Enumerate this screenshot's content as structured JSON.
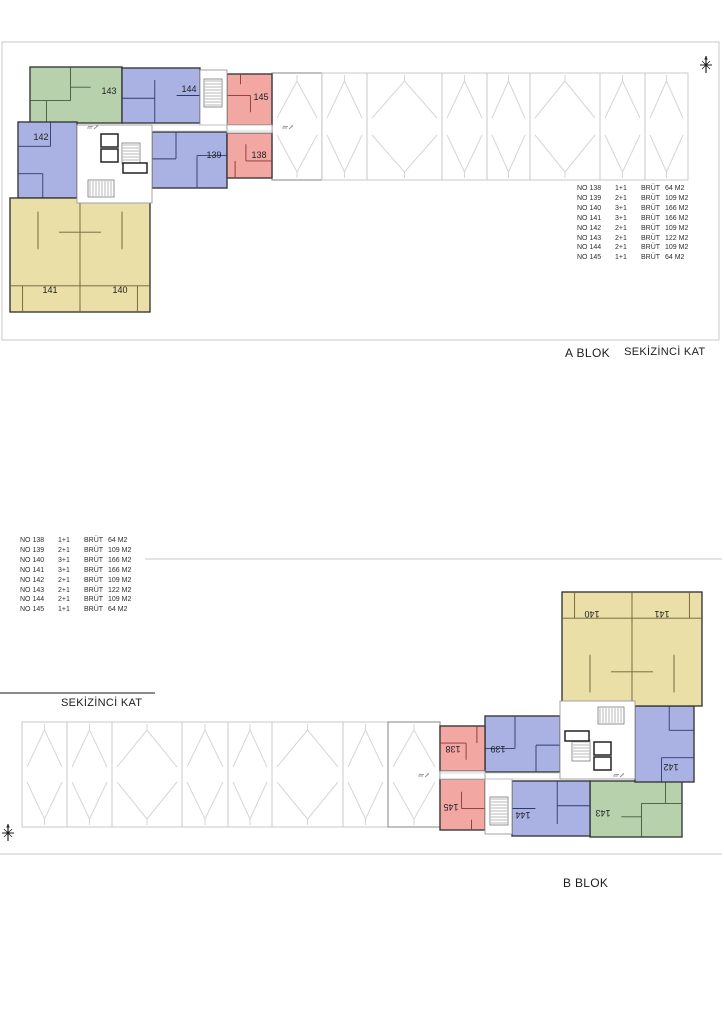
{
  "titles": {
    "a_block": "A BLOK",
    "a_floor": "SEKİZİNCİ KAT",
    "b_block": "B BLOK",
    "b_floor": "SEKİZİNCİ KAT"
  },
  "legend": {
    "rows": [
      {
        "no": "NO 138",
        "tip": "1+1",
        "brut": "BRÜT",
        "m2": "64 M2"
      },
      {
        "no": "NO 139",
        "tip": "2+1",
        "brut": "BRÜT",
        "m2": "109 M2"
      },
      {
        "no": "NO 140",
        "tip": "3+1",
        "brut": "BRÜT",
        "m2": "166 M2"
      },
      {
        "no": "NO 141",
        "tip": "3+1",
        "brut": "BRÜT",
        "m2": "166 M2"
      },
      {
        "no": "NO 142",
        "tip": "2+1",
        "brut": "BRÜT",
        "m2": "109 M2"
      },
      {
        "no": "NO 143",
        "tip": "2+1",
        "brut": "BRÜT",
        "m2": "122 M2"
      },
      {
        "no": "NO 144",
        "tip": "2+1",
        "brut": "BRÜT",
        "m2": "109 M2"
      },
      {
        "no": "NO 145",
        "tip": "1+1",
        "brut": "BRÜT",
        "m2": "64 M2"
      }
    ]
  },
  "colors": {
    "green": "#b7d1ad",
    "blue": "#a9b2e2",
    "red": "#f2a7a3",
    "yellow": "#eadfa6",
    "green_dark": "#3c5a3c",
    "blue_dark": "#2c3a72",
    "red_dark": "#8a3535",
    "yellow_dark": "#6b6138",
    "outline": "#3a3a3a",
    "frame": "#c9c9c9",
    "roof": "#d6d6d6",
    "midgray": "#9a9a9a",
    "core": "#9a9a9a",
    "label": "#222222",
    "note": "#8a8a8a"
  },
  "plan": {
    "a_origin": {
      "x": 10,
      "y": 67,
      "w": 262,
      "h": 245
    },
    "b_origin": {
      "x": 442,
      "y": 592,
      "w": 260,
      "h": 245
    },
    "units": [
      {
        "id": "143",
        "color": "green",
        "x": 30,
        "y": 67,
        "w": 92,
        "h": 56,
        "labels": [
          {
            "text": "143",
            "x": 109,
            "y": 91
          }
        ],
        "walls": [
          [
            0.44,
            0,
            0.44,
            0.6
          ],
          [
            0,
            0.6,
            0.44,
            0.6
          ],
          [
            0.44,
            0.36,
            0.66,
            0.36
          ],
          [
            0.18,
            0.6,
            0.18,
            1
          ]
        ]
      },
      {
        "id": "144",
        "color": "blue",
        "x": 122,
        "y": 68,
        "w": 78,
        "h": 55,
        "labels": [
          {
            "text": "144",
            "x": 189,
            "y": 89
          }
        ],
        "walls": [
          [
            0.42,
            0.22,
            0.42,
            1
          ],
          [
            0,
            0.55,
            0.42,
            0.55
          ],
          [
            0.7,
            0.5,
            1,
            0.5
          ]
        ]
      },
      {
        "id": "145",
        "color": "red",
        "x": 227,
        "y": 74,
        "w": 45,
        "h": 51,
        "labels": [
          {
            "text": "145",
            "x": 261,
            "y": 97
          }
        ],
        "walls": [
          [
            0,
            0.42,
            0.52,
            0.42
          ],
          [
            0.52,
            0.42,
            0.52,
            0.75
          ],
          [
            0.3,
            0,
            0.3,
            0.2
          ]
        ]
      },
      {
        "id": "142",
        "color": "blue",
        "x": 18,
        "y": 122,
        "w": 59,
        "h": 76,
        "labels": [
          {
            "text": "142",
            "x": 41,
            "y": 137
          }
        ],
        "walls": [
          [
            0,
            0.32,
            0.55,
            0.32
          ],
          [
            0.55,
            0,
            0.55,
            0.32
          ],
          [
            0,
            0.68,
            0.42,
            0.68
          ],
          [
            0.42,
            0.68,
            0.42,
            1
          ]
        ]
      },
      {
        "id": "139",
        "color": "blue",
        "x": 152,
        "y": 132,
        "w": 75,
        "h": 56,
        "labels": [
          {
            "text": "139",
            "x": 214,
            "y": 155
          }
        ],
        "walls": [
          [
            0.32,
            0,
            0.32,
            0.48
          ],
          [
            0,
            0.48,
            0.32,
            0.48
          ],
          [
            0.6,
            0.42,
            1,
            0.42
          ],
          [
            0.6,
            0.42,
            0.6,
            1
          ]
        ]
      },
      {
        "id": "138",
        "color": "red",
        "x": 227,
        "y": 133,
        "w": 45,
        "h": 45,
        "labels": [
          {
            "text": "138",
            "x": 259,
            "y": 155
          }
        ],
        "walls": [
          [
            0.42,
            0.25,
            0.42,
            0.62
          ],
          [
            0.42,
            0.62,
            1,
            0.62
          ],
          [
            0.18,
            0.62,
            0.18,
            1
          ]
        ]
      },
      {
        "id": "140-141",
        "color": "yellow",
        "x": 10,
        "y": 198,
        "w": 140,
        "h": 114,
        "labels": [
          {
            "text": "141",
            "x": 50,
            "y": 290
          },
          {
            "text": "140",
            "x": 120,
            "y": 290
          }
        ],
        "walls": [
          [
            0.5,
            0,
            0.5,
            1
          ],
          [
            0,
            0.77,
            1,
            0.77
          ],
          [
            0.2,
            0.12,
            0.2,
            0.45
          ],
          [
            0.8,
            0.12,
            0.8,
            0.45
          ],
          [
            0.35,
            0.3,
            0.65,
            0.3
          ],
          [
            0.09,
            0.77,
            0.09,
            1
          ],
          [
            0.91,
            0.77,
            0.91,
            1
          ]
        ]
      }
    ],
    "features": [
      {
        "t": "room",
        "x": 200,
        "y": 70,
        "w": 27,
        "h": 55
      },
      {
        "t": "room",
        "x": 77,
        "y": 125,
        "w": 75,
        "h": 78
      },
      {
        "t": "room",
        "x": 227,
        "y": 125,
        "w": 45,
        "h": 8
      },
      {
        "t": "stairs",
        "x": 204,
        "y": 79,
        "w": 18,
        "h": 28,
        "o": "h"
      },
      {
        "t": "stairs",
        "x": 122,
        "y": 143,
        "w": 18,
        "h": 21,
        "o": "h"
      },
      {
        "t": "stairs",
        "x": 88,
        "y": 180,
        "w": 26,
        "h": 17,
        "o": "v"
      },
      {
        "t": "lift",
        "x": 101,
        "y": 134,
        "w": 17,
        "h": 13
      },
      {
        "t": "lift",
        "x": 101,
        "y": 149,
        "w": 17,
        "h": 13
      },
      {
        "t": "lift",
        "x": 123,
        "y": 163,
        "w": 24,
        "h": 10
      },
      {
        "t": "line",
        "x1": 152,
        "y1": 125,
        "x2": 272,
        "y2": 125
      },
      {
        "t": "line",
        "x1": 152,
        "y1": 131,
        "x2": 272,
        "y2": 131
      },
      {
        "t": "note",
        "x": 93,
        "y": 128
      },
      {
        "t": "note",
        "x": 288,
        "y": 128
      }
    ]
  },
  "sheets": {
    "a": {
      "frame": {
        "x": 2,
        "y": 42,
        "w": 717,
        "h": 298
      },
      "strip": {
        "y1": 73,
        "y2": 180,
        "dividers": [
          272,
          322,
          367,
          442,
          487,
          530,
          600,
          645,
          688
        ],
        "dark": 0
      },
      "compass": {
        "x": 706,
        "y": 65
      }
    },
    "b": {
      "lines": [
        {
          "x1": 145,
          "y1": 559,
          "x2": 722,
          "y2": 559
        },
        {
          "x1": 0,
          "y1": 854,
          "x2": 722,
          "y2": 854
        }
      ],
      "strip": {
        "y1": 722,
        "y2": 827,
        "dividers": [
          22,
          67,
          112,
          182,
          228,
          272,
          343,
          388,
          440
        ],
        "dark": 7
      },
      "compass": {
        "x": 8,
        "y": 833
      }
    }
  }
}
